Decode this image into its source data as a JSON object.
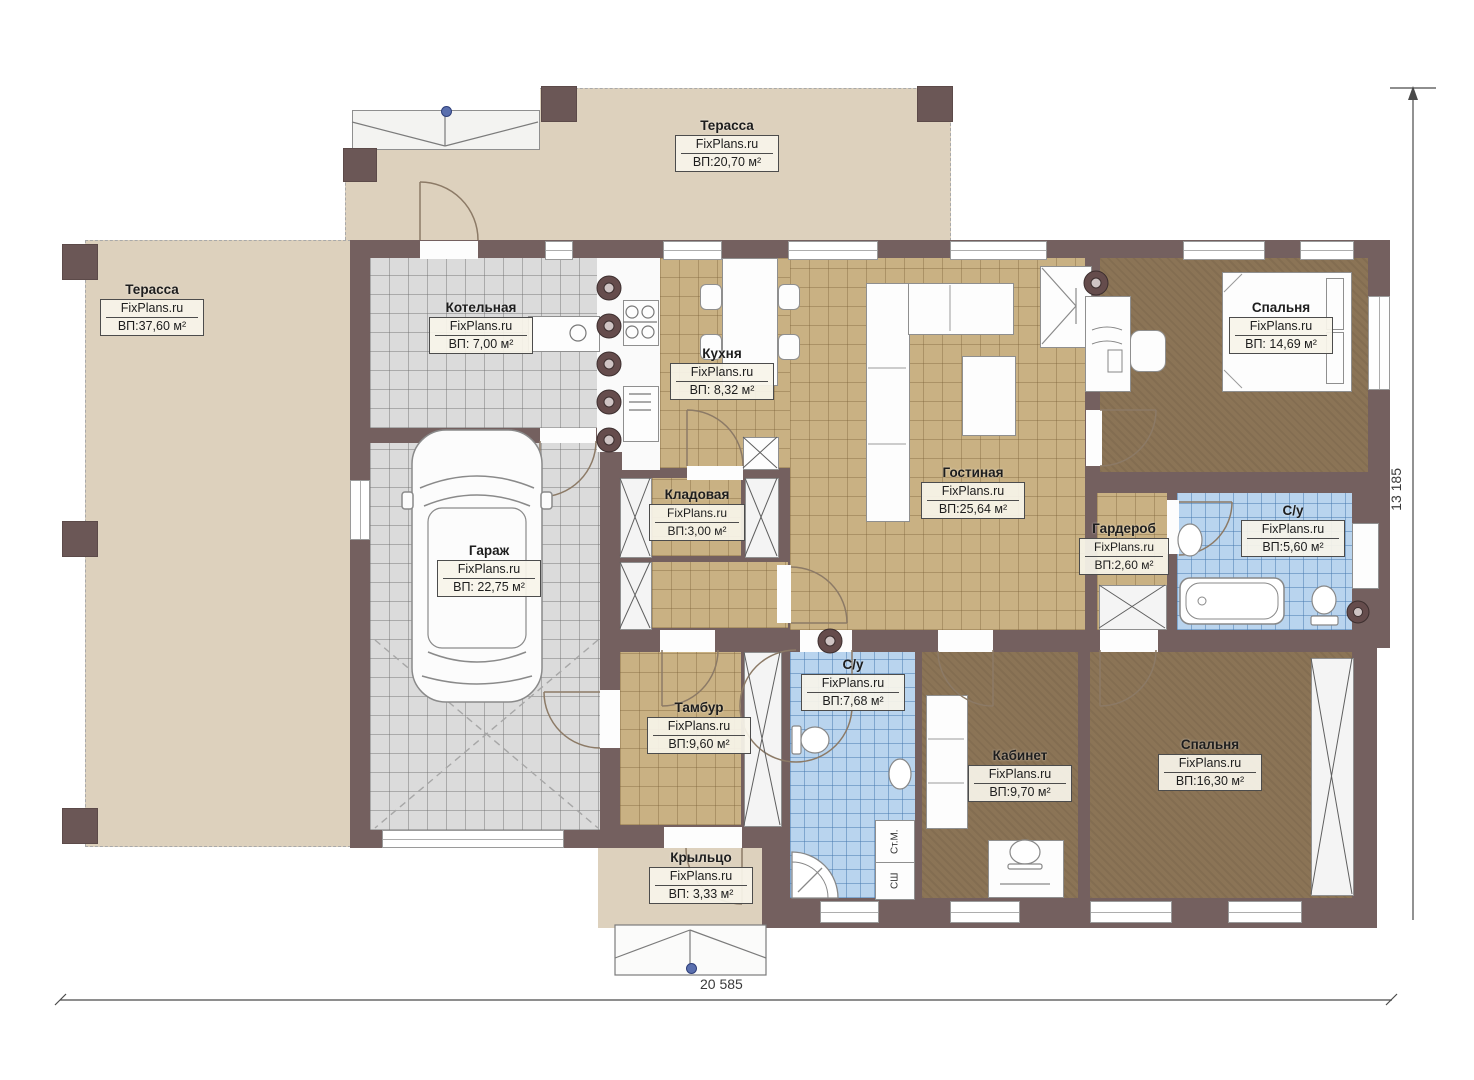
{
  "watermark": "FixPlans.ru",
  "rooms": [
    {
      "id": "terrace-top",
      "name": "Терасса",
      "area": "ВП:20,70 м²"
    },
    {
      "id": "terrace-left",
      "name": "Терасса",
      "area": "ВП:37,60 м²"
    },
    {
      "id": "boiler",
      "name": "Котельная",
      "area": "ВП: 7,00 м²"
    },
    {
      "id": "kitchen",
      "name": "Кухня",
      "area": "ВП: 8,32 м²"
    },
    {
      "id": "living",
      "name": "Гостиная",
      "area": "ВП:25,64 м²"
    },
    {
      "id": "bedroom-1",
      "name": "Спальня",
      "area": "ВП: 14,69 м²"
    },
    {
      "id": "storage",
      "name": "Кладовая",
      "area": "ВП:3,00 м²"
    },
    {
      "id": "garage",
      "name": "Гараж",
      "area": "ВП: 22,75 м²"
    },
    {
      "id": "wardrobe",
      "name": "Гардероб",
      "area": "ВП:2,60 м²"
    },
    {
      "id": "bath-1",
      "name": "С/у",
      "area": "ВП:5,60 м²"
    },
    {
      "id": "tambour",
      "name": "Тамбур",
      "area": "ВП:9,60 м²"
    },
    {
      "id": "bath-2",
      "name": "С/у",
      "area": "ВП:7,68 м²"
    },
    {
      "id": "office",
      "name": "Кабинет",
      "area": "ВП:9,70 м²"
    },
    {
      "id": "bedroom-2",
      "name": "Спальня",
      "area": "ВП:16,30 м²"
    },
    {
      "id": "porch",
      "name": "Крыльцо",
      "area": "ВП: 3,33 м²"
    }
  ],
  "appliance_labels": {
    "washing_machine": "Ст.М.",
    "drying_cabinet": "СШ"
  },
  "dimensions": {
    "width": "20 585",
    "height": "13 185"
  },
  "colors": {
    "wall": "#74605f",
    "terrace": "#ddd1bd",
    "wood_floor": "#c9b183",
    "brown_floor": "#8b7456",
    "tile_blue": "#b9d4ee",
    "garage_floor": "#dbdbdb",
    "label_bg": "#f8f4e9",
    "marker_blue": "#5a6fae"
  }
}
